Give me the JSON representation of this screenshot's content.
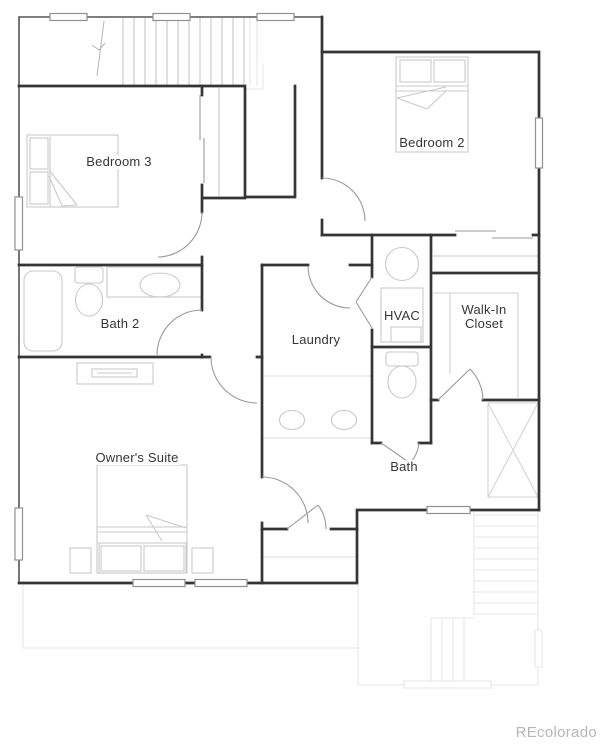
{
  "watermark": "REcolorado",
  "floor_plan": {
    "labels": {
      "bedroom3": "Bedroom 3",
      "bedroom2": "Bedroom 2",
      "bath2": "Bath 2",
      "laundry": "Laundry",
      "hvac": "HVAC",
      "walk_in_closet": "Walk-In\nCloset",
      "owners_suite": "Owner's Suite",
      "bath": "Bath"
    },
    "fixtures": [
      "staircase-down",
      "bed",
      "pillows",
      "closet-rod",
      "bifold-door",
      "bypass-door",
      "bathtub",
      "toilet",
      "sink",
      "double-vanity",
      "water-heater",
      "hvac-unit",
      "dresser",
      "nightstand",
      "x-braced-chase",
      "windows",
      "lower-level-stairs"
    ],
    "colors": {
      "wall": "#353535",
      "exterior_wall": "#555555",
      "door_swing": "#9a9a9a",
      "furniture": "#c9c9c9",
      "faint_lower_level": "#e4e4e4",
      "label_text": "#363636",
      "watermark_text": "#b6b6b6"
    }
  }
}
